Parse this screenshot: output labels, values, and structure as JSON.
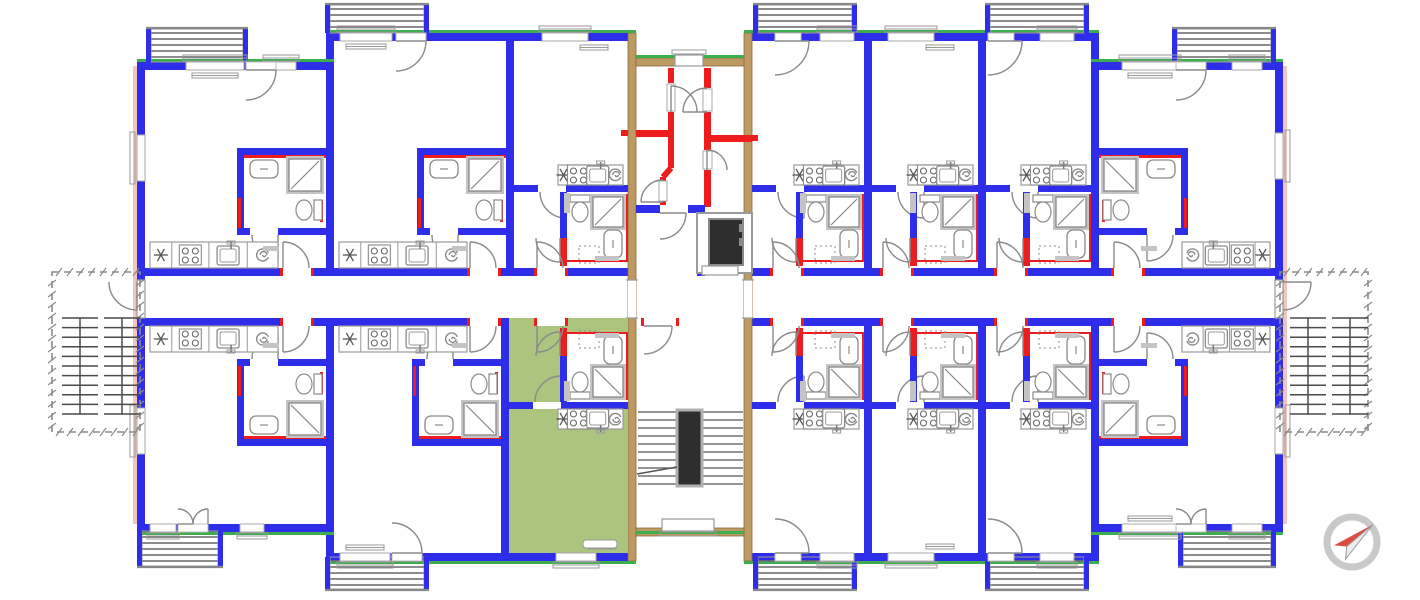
{
  "title": "apartment-building-floor-plan",
  "colors": {
    "wall": "#2e2eea",
    "green": "#3cae4e",
    "red": "#ee1c1c",
    "tan": "#bd9a61",
    "tanEdge": "#8a6c3c",
    "pink": "#f2c6be",
    "fixture": "#8a8a8a",
    "fixtureLight": "#c4c4c4",
    "dark": "#2e2e2e",
    "roomGreen": "#abc47e",
    "hatch": "#707070",
    "stair": "#555555",
    "dash": "#8a8a8a",
    "compassRing": "#c9c9c9",
    "compassRed": "#dd4b41",
    "white": "#ffffff"
  },
  "icons": [
    "compass-north-icon",
    "elevator-icon",
    "staircase-icon",
    "stove-icon",
    "kitchen-sink-icon",
    "extractor-spiral-icon",
    "hob-star-icon",
    "toilet-icon",
    "shower-icon",
    "washbasin-icon",
    "door-swing-icon",
    "window-icon",
    "balcony-hatch-icon",
    "radiator-icon"
  ],
  "plan": {
    "canvas": [
      1420,
      600
    ],
    "mirrorAxisY": 594,
    "corridor": {
      "topWallY": 268,
      "bottomWallY": 318,
      "wallT": 8,
      "leftRun": [
        145,
        628
      ],
      "rightRun": [
        752,
        1275
      ],
      "endDoors": [
        [
          137,
          280,
          8,
          38
        ],
        [
          1275,
          280,
          8,
          38
        ]
      ]
    },
    "walls": [
      [
        137,
        62,
        8,
        466
      ],
      [
        1275,
        62,
        8,
        466
      ],
      [
        137,
        62,
        197,
        8
      ],
      [
        326,
        33,
        310,
        8
      ],
      [
        744,
        33,
        355,
        8
      ],
      [
        1091,
        62,
        192,
        8
      ],
      [
        326,
        33,
        8,
        37
      ],
      [
        1091,
        33,
        8,
        37
      ],
      [
        137,
        524,
        197,
        8
      ],
      [
        326,
        553,
        310,
        8
      ],
      [
        744,
        553,
        355,
        8
      ],
      [
        1091,
        524,
        192,
        8
      ],
      [
        326,
        524,
        8,
        37
      ],
      [
        1091,
        524,
        8,
        37
      ],
      [
        145,
        268,
        483,
        8
      ],
      [
        752,
        268,
        523,
        8
      ],
      [
        145,
        318,
        483,
        8
      ],
      [
        752,
        318,
        523,
        8
      ],
      [
        326,
        41,
        8,
        227
      ],
      [
        506,
        41,
        8,
        227
      ],
      [
        864,
        41,
        8,
        227
      ],
      [
        978,
        41,
        8,
        227
      ],
      [
        1091,
        70,
        8,
        198
      ],
      [
        326,
        326,
        8,
        227
      ],
      [
        501,
        326,
        8,
        227
      ],
      [
        864,
        326,
        8,
        227
      ],
      [
        978,
        326,
        8,
        227
      ],
      [
        1091,
        326,
        8,
        227
      ]
    ],
    "tanWalls": [
      [
        628,
        33,
        8,
        528
      ],
      [
        744,
        33,
        8,
        528
      ],
      [
        636,
        58,
        108,
        8
      ],
      [
        636,
        528,
        108,
        8
      ]
    ],
    "greenLines": [
      [
        137,
        59,
        197,
        3
      ],
      [
        326,
        30,
        310,
        3
      ],
      [
        636,
        55,
        108,
        3
      ],
      [
        744,
        30,
        355,
        3
      ],
      [
        1091,
        59,
        192,
        3
      ],
      [
        137,
        532,
        197,
        3
      ],
      [
        326,
        561,
        310,
        3
      ],
      [
        636,
        531,
        108,
        3
      ],
      [
        744,
        561,
        355,
        3
      ],
      [
        1091,
        532,
        192,
        3
      ]
    ],
    "pinkLines": [
      [
        133,
        66,
        4,
        458
      ],
      [
        1283,
        66,
        4,
        458
      ]
    ],
    "sideWindows": [
      [
        137,
        135,
        8,
        46
      ],
      [
        137,
        408,
        8,
        46
      ],
      [
        1275,
        133,
        8,
        46
      ],
      [
        1275,
        408,
        8,
        46
      ]
    ],
    "units": [
      {
        "id": "apt-01",
        "type": "wide",
        "side": "N",
        "L": 145,
        "R": 326,
        "wallY": 62,
        "hand": "R",
        "kitchenW": 128,
        "entry": 283,
        "balcony": {
          "x": 146,
          "y": 27,
          "w": 102,
          "h": 35
        },
        "windows": [
          [
            186,
            58
          ],
          [
            266,
            30
          ]
        ],
        "balconyDoor": 246,
        "french": false,
        "highlight": false
      },
      {
        "id": "apt-02",
        "type": "wide",
        "side": "N",
        "L": 334,
        "R": 506,
        "wallY": 33,
        "hand": "R",
        "kitchenW": 128,
        "entry": 470,
        "balcony": {
          "x": 325,
          "y": 3,
          "w": 104,
          "h": 30
        },
        "windows": [
          [
            340,
            52
          ]
        ],
        "balconyDoor": 396,
        "french": false,
        "highlight": false
      },
      {
        "id": "apt-03",
        "type": "studio",
        "side": "N",
        "L": 514,
        "R": 628,
        "entry": 537,
        "windows": [
          [
            542,
            46
          ]
        ],
        "balcony": null,
        "balconyDoor": null,
        "french": false,
        "highlight": false
      },
      {
        "id": "apt-04",
        "type": "studio",
        "side": "N",
        "L": 752,
        "R": 864,
        "entry": 773,
        "balcony": {
          "x": 753,
          "y": 3,
          "w": 104,
          "h": 30
        },
        "balconyDoor": 775,
        "windows": [
          [
            820,
            34
          ]
        ],
        "french": false,
        "highlight": false
      },
      {
        "id": "apt-05",
        "type": "studio",
        "side": "N",
        "L": 872,
        "R": 978,
        "entry": 883,
        "windows": [
          [
            888,
            46
          ]
        ],
        "balcony": null,
        "balconyDoor": null,
        "french": false,
        "highlight": false
      },
      {
        "id": "apt-06",
        "type": "studio",
        "side": "N",
        "L": 986,
        "R": 1091,
        "entry": 997,
        "balcony": {
          "x": 985,
          "y": 3,
          "w": 104,
          "h": 30
        },
        "balconyDoor": 988,
        "windows": [
          [
            1040,
            34
          ]
        ],
        "french": false,
        "highlight": false
      },
      {
        "id": "apt-07",
        "type": "wide",
        "side": "N",
        "L": 1099,
        "R": 1275,
        "wallY": 62,
        "hand": "L",
        "kitchenW": 88,
        "entry": 1114,
        "balcony": {
          "x": 1172,
          "y": 27,
          "w": 104,
          "h": 35
        },
        "windows": [
          [
            1122,
            56
          ],
          [
            1232,
            30
          ]
        ],
        "balconyDoor": 1176,
        "french": false,
        "highlight": false
      },
      {
        "id": "apt-08",
        "type": "wide",
        "side": "S",
        "L": 145,
        "R": 326,
        "wallY": 62,
        "hand": "R",
        "kitchenW": 128,
        "entry": 283,
        "balcony": {
          "x": 137,
          "y": 26,
          "w": 86,
          "h": 37
        },
        "windows": [
          [
            150,
            26
          ],
          [
            240,
            24
          ]
        ],
        "balconyDoor": 178,
        "french": true,
        "highlight": false
      },
      {
        "id": "apt-09",
        "type": "wide",
        "side": "S",
        "L": 334,
        "R": 501,
        "wallY": 33,
        "hand": "R",
        "kitchenW": 128,
        "entry": 470,
        "balcony": {
          "x": 325,
          "y": 3,
          "w": 104,
          "h": 34
        },
        "windows": [
          [
            340,
            50
          ]
        ],
        "balconyDoor": 392,
        "french": false,
        "highlight": false
      },
      {
        "id": "apt-10",
        "type": "studio",
        "side": "S",
        "L": 509,
        "R": 628,
        "entry": 537,
        "windows": [
          [
            556,
            40
          ]
        ],
        "balcony": null,
        "balconyDoor": null,
        "french": false,
        "highlight": true
      },
      {
        "id": "apt-11",
        "type": "studio",
        "side": "S",
        "L": 752,
        "R": 864,
        "entry": 773,
        "balcony": {
          "x": 753,
          "y": 3,
          "w": 104,
          "h": 34
        },
        "balconyDoor": 775,
        "windows": [
          [
            820,
            34
          ]
        ],
        "french": false,
        "highlight": false
      },
      {
        "id": "apt-12",
        "type": "studio",
        "side": "S",
        "L": 872,
        "R": 978,
        "entry": 883,
        "windows": [
          [
            888,
            46
          ]
        ],
        "balcony": null,
        "balconyDoor": null,
        "french": false,
        "highlight": false
      },
      {
        "id": "apt-13",
        "type": "studio",
        "side": "S",
        "L": 986,
        "R": 1091,
        "entry": 997,
        "balcony": {
          "x": 985,
          "y": 3,
          "w": 104,
          "h": 34
        },
        "balconyDoor": 988,
        "windows": [
          [
            1040,
            34
          ]
        ],
        "french": false,
        "highlight": false
      },
      {
        "id": "apt-14",
        "type": "wide",
        "side": "S",
        "L": 1099,
        "R": 1275,
        "wallY": 62,
        "hand": "L",
        "kitchenW": 88,
        "entry": 1114,
        "balcony": {
          "x": 1178,
          "y": 26,
          "w": 98,
          "h": 37
        },
        "windows": [
          [
            1122,
            56
          ],
          [
            1232,
            30
          ]
        ],
        "balconyDoor": 1176,
        "french": true,
        "highlight": false
      }
    ],
    "core": {
      "x": 628,
      "w": 124,
      "innerL": 636,
      "innerR": 744,
      "topWindow": [
        675,
        55,
        28,
        11
      ],
      "bottomWindow": [
        662,
        519,
        52,
        12
      ],
      "redVerticals": [
        [
          668,
          68,
          6,
          15
        ],
        [
          668,
          112,
          6,
          56
        ],
        [
          660,
          177,
          6,
          28
        ],
        [
          704,
          68,
          7,
          20
        ],
        [
          704,
          112,
          7,
          38
        ],
        [
          704,
          170,
          7,
          37
        ]
      ],
      "redHorizontals": [
        [
          636,
          130,
          32,
          7
        ],
        [
          711,
          135,
          41,
          7
        ]
      ],
      "redStubs": [
        [
          621,
          130,
          7,
          6
        ],
        [
          621,
          205,
          7,
          6
        ],
        [
          752,
          135,
          6,
          6
        ]
      ],
      "vestibuleWalls": [
        [
          636,
          205,
          24,
          8
        ],
        [
          688,
          205,
          17,
          8
        ],
        [
          697,
          205,
          8,
          71
        ]
      ],
      "elevator": {
        "shaft": [
          697,
          213,
          55,
          60
        ],
        "car": [
          709,
          219,
          34,
          46
        ],
        "door": [
          702,
          266,
          36,
          9
        ]
      },
      "passOpenings": [
        [
          628,
          280,
          8,
          38
        ],
        [
          744,
          280,
          8,
          38
        ]
      ],
      "stairDoor": [
        644,
        318,
        32,
        8
      ],
      "stairs": {
        "flightL": [
          638,
          677
        ],
        "flightR": [
          702,
          743
        ],
        "treadTop": 412,
        "treadStep": 8,
        "treads": 10,
        "well": [
          677,
          410,
          25,
          76
        ]
      }
    },
    "neighbors": [
      {
        "x": 52,
        "y": 272,
        "w": 88,
        "h": 160,
        "side": "left",
        "flights": [
          [
            62,
            318,
            36,
            96
          ],
          [
            104,
            318,
            36,
            96
          ]
        ]
      },
      {
        "x": 1280,
        "y": 272,
        "w": 88,
        "h": 160,
        "side": "right",
        "flights": [
          [
            1290,
            318,
            36,
            96
          ],
          [
            1332,
            318,
            36,
            96
          ]
        ]
      }
    ],
    "compass": {
      "cx": 1352,
      "cy": 542,
      "r": 25,
      "angle": -40
    }
  }
}
